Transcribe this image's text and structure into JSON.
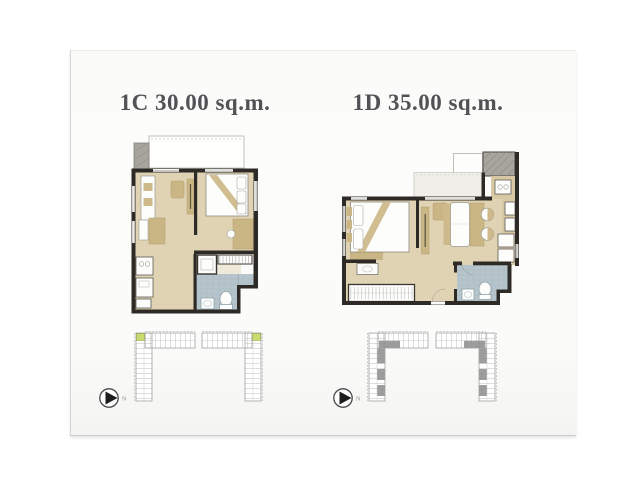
{
  "units": [
    {
      "name": "1C",
      "area": "30.00",
      "area_unit": "sq.m.",
      "title": "1C 30.00 sq.m.",
      "north_label": "N",
      "keyplan_highlight_color": "#c9da6f"
    },
    {
      "name": "1D",
      "area": "35.00",
      "area_unit": "sq.m.",
      "title": "1D 35.00 sq.m.",
      "north_label": "N",
      "keyplan_highlight_color": "#8c8c8c"
    }
  ],
  "palette": {
    "background": "#ffffff",
    "paper": "#fbfbfa",
    "title_text": "#515156",
    "floor_tan": "#e0d3b3",
    "furniture_tan": "#cab685",
    "wall_black": "#2e2b27",
    "bathroom_blue": "#b6c5cb",
    "balcony_gray": "#a6a59e",
    "keyplan_line": "#a2a2a2"
  }
}
